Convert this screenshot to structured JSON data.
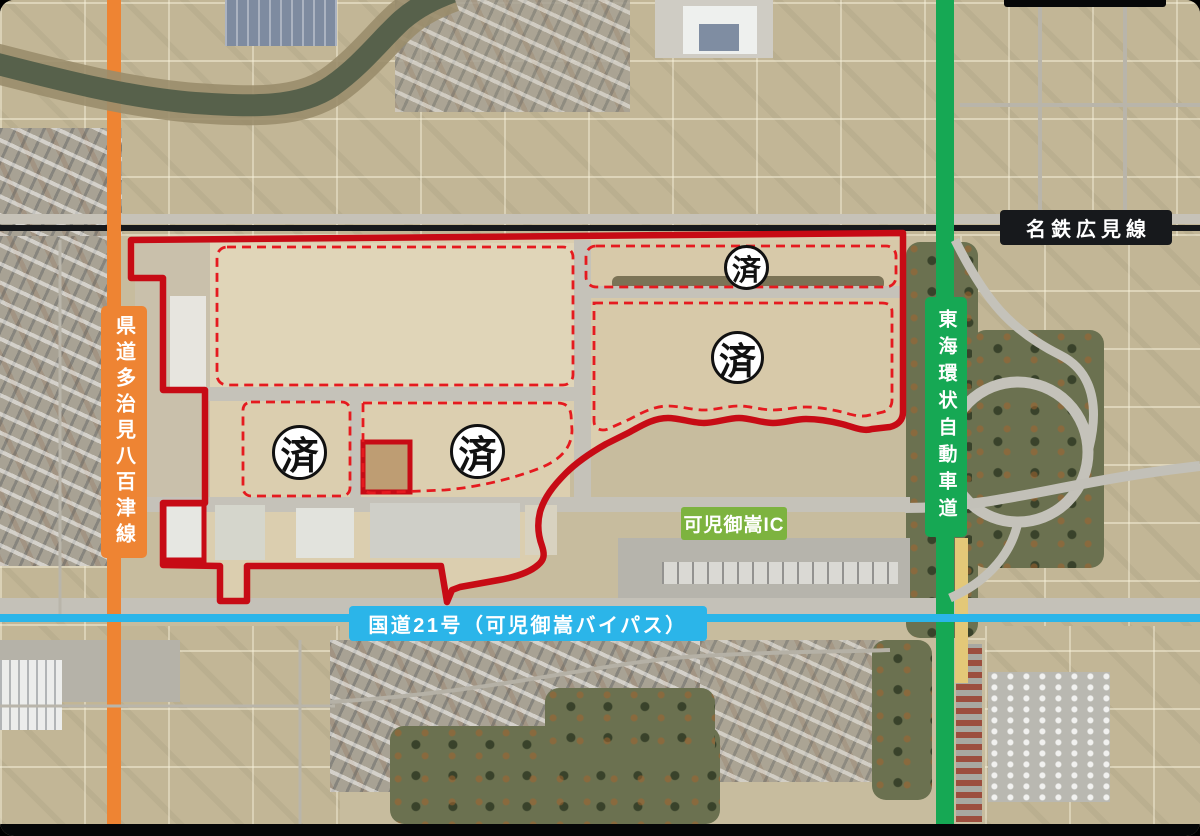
{
  "annotations": {
    "railway_label": "名鉄広見線",
    "pref_road_label": "県道多治見八百津線",
    "expressway_label": "東海環状自動車道",
    "national_route_label": "国道21号（可児御嵩バイパス）",
    "interchange_label": "可児御嵩IC",
    "completed_markers": [
      {
        "text": "済"
      },
      {
        "text": "済"
      },
      {
        "text": "済"
      },
      {
        "text": "済"
      }
    ]
  },
  "colors": {
    "railway_black": "#17191c",
    "pref_road_orange": "#ee8433",
    "expressway_green": "#16a854",
    "route21_blue": "#2bb5e9",
    "interchange_green": "#7db33f",
    "site_boundary_red": "#c70b15",
    "phase_dashed_red": "#e51a1f",
    "marker_background": "#ffffff"
  }
}
